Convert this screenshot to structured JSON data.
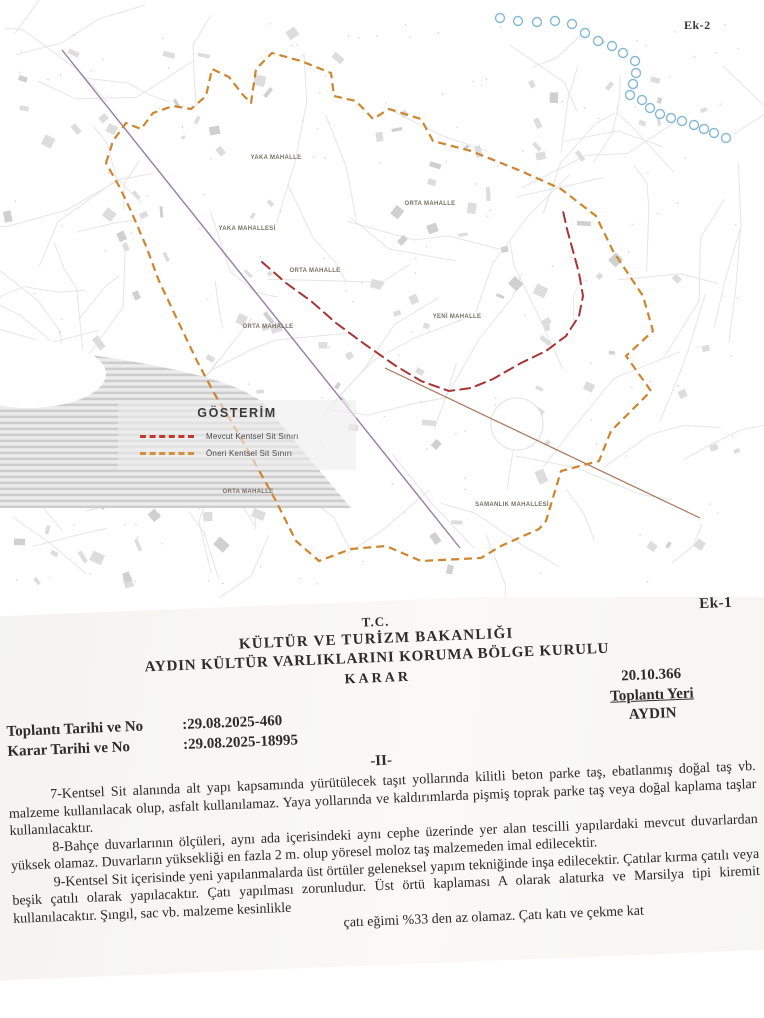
{
  "map": {
    "sheet_label": "Ek-2",
    "legend": {
      "title": "GÖSTERİM",
      "items": [
        {
          "label": "Mevcut Kentsel Sit Sınırı",
          "color": "#c0392b",
          "style": "dashed"
        },
        {
          "label": "Öneri Kentsel Sit Sınırı",
          "color": "#d4913a",
          "style": "dashed"
        }
      ]
    },
    "district_labels": [
      {
        "text": "YAKA MAHALLE"
      },
      {
        "text": "YAKA MAHALLESİ"
      },
      {
        "text": "ORTA MAHALLE"
      },
      {
        "text": "ORTA MAHALLE"
      },
      {
        "text": "ORTA MAHALLE"
      },
      {
        "text": "YENİ MAHALLE"
      },
      {
        "text": "ORTA MAHALLE"
      },
      {
        "text": "SAMANLIK MAHALLESİ"
      }
    ],
    "boundary_colors": {
      "existing": "#a83434",
      "proposed": "#cd8530"
    }
  },
  "document": {
    "sheet_label": "Ek-1",
    "header": [
      "T.C.",
      "KÜLTÜR VE TURİZM BAKANLIĞI",
      "AYDIN KÜLTÜR VARLIKLARINI KORUMA BÖLGE KURULU",
      "KARAR"
    ],
    "decision_no": "20.10.366",
    "meeting_place_label": "Toplantı Yeri",
    "meeting_place": "AYDIN",
    "rows": {
      "meeting": {
        "label": "Toplantı Tarihi ve  No",
        "value": ":29.08.2025-460"
      },
      "decision": {
        "label": "Karar Tarihi ve No",
        "value": ":29.08.2025-18995"
      }
    },
    "section": "-II-",
    "paragraphs": [
      "7-Kentsel Sit alanında alt yapı kapsamında yürütülecek taşıt yollarında kilitli beton parke taş, ebatlanmış doğal taş vb. malzeme kullanılacak olup, asfalt kullanılamaz. Yaya yollarında ve kaldırımlarda pişmiş toprak parke taş veya doğal kaplama taşlar kullanılacaktır.",
      "8-Bahçe duvarlarının ölçüleri, aynı ada içerisindeki aynı cephe üzerinde yer alan tescilli yapılardaki mevcut duvarlardan yüksek olamaz. Duvarların yüksekliği en fazla 2 m. olup yöresel moloz taş malzemeden imal edilecektir.",
      "9-Kentsel Sit içerisinde yeni yapılanmalarda üst örtüler geleneksel yapım tekniğinde inşa edilecektir. Çatılar kırma çatılı veya beşik çatılı olarak yapılacaktır. Çatı yapılması zorunludur. Üst örtü kaplaması A olarak alaturka ve Marsilya tipi kiremit kullanılacaktır. Şıngıl, sac vb. malzeme kesinlikle"
    ],
    "last_line_fragment": "çatı eğimi %33 den az olamaz. Çatı katı ve çekme kat"
  }
}
